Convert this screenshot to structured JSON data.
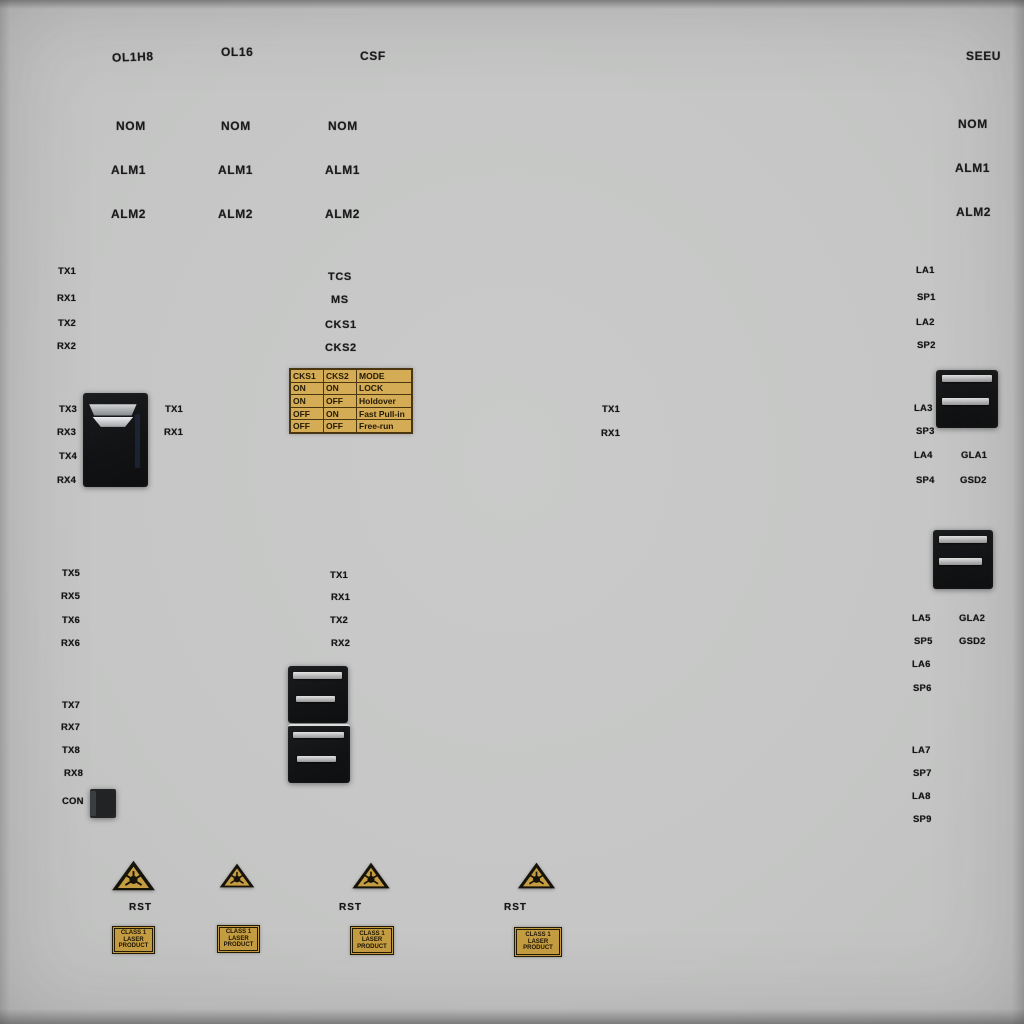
{
  "panel": {
    "background": "#c6c7c6",
    "gold": "#c49c42",
    "table_gold": "#d4ac55",
    "text": "#161616"
  },
  "titles": {
    "card1": "OL1H8",
    "card2": "OL16",
    "card3": "CSF",
    "card4": "SEEU"
  },
  "led_labels": {
    "nom": "NOM",
    "alm1": "ALM1",
    "alm2": "ALM2"
  },
  "left_card": {
    "ports_top": [
      "TX1",
      "RX1",
      "TX2",
      "RX2"
    ],
    "conn1_left": [
      "TX3",
      "RX3",
      "TX4",
      "RX4"
    ],
    "conn1_right": [
      "TX1",
      "RX1"
    ],
    "ports_mid": [
      "TX5",
      "RX5",
      "TX6",
      "RX6"
    ],
    "ports_low": [
      "TX7",
      "RX7",
      "TX8",
      "RX8"
    ],
    "con_label": "CON"
  },
  "center_card": {
    "clock_labels": [
      "TCS",
      "MS",
      "CKS1",
      "CKS2"
    ],
    "mode_table": {
      "headers": [
        "CKS1",
        "CKS2",
        "MODE"
      ],
      "rows": [
        [
          "ON",
          "ON",
          "LOCK"
        ],
        [
          "ON",
          "OFF",
          "Holdover"
        ],
        [
          "OFF",
          "ON",
          "Fast Pull-in"
        ],
        [
          "OFF",
          "OFF",
          "Free-run"
        ]
      ]
    },
    "ports": [
      "TX1",
      "RX1",
      "TX2",
      "RX2"
    ]
  },
  "mid_ports": [
    "TX1",
    "RX1"
  ],
  "right_card": {
    "ports_top": [
      "LA1",
      "SP1",
      "LA2",
      "SP2"
    ],
    "group2_left": [
      "LA3",
      "SP3",
      "LA4",
      "SP4"
    ],
    "group2_right": [
      "GLA1",
      "GSD2"
    ],
    "group3_left": [
      "LA5",
      "SP5",
      "LA6",
      "SP6"
    ],
    "group3_right": [
      "GLA2",
      "GSD2"
    ],
    "group4": [
      "LA7",
      "SP7",
      "LA8",
      "SP9"
    ]
  },
  "bottom": {
    "rst_label": "RST",
    "laser_label_lines": [
      "CLASS 1",
      "LASER",
      "PRODUCT"
    ]
  }
}
